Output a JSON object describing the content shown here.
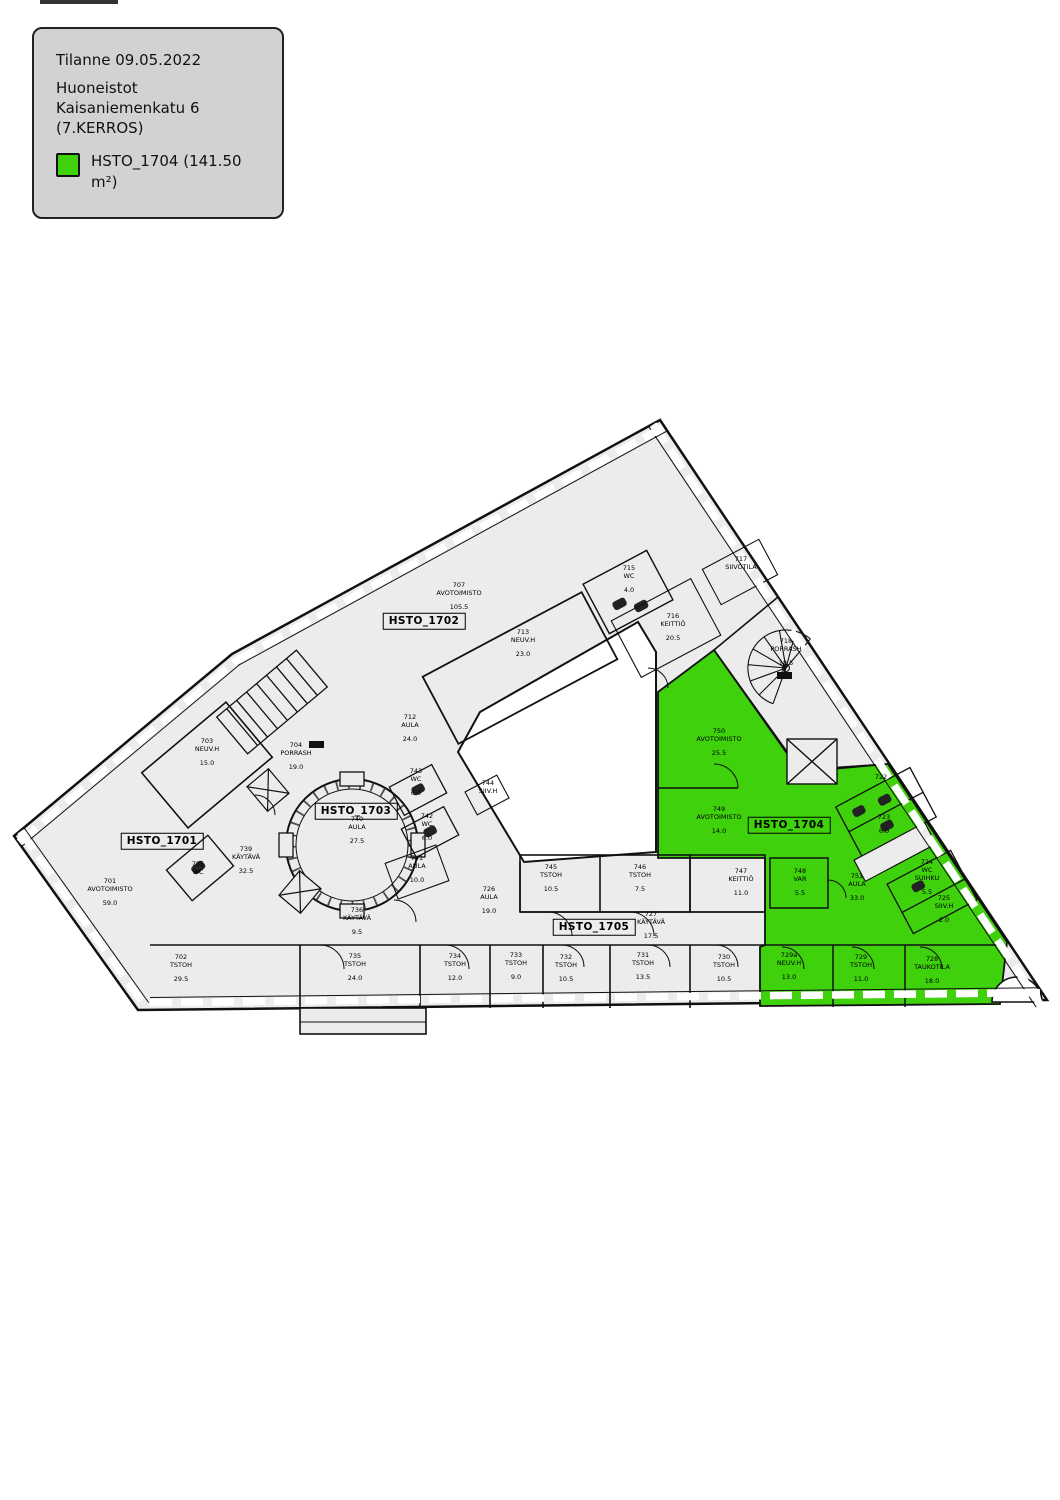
{
  "colors": {
    "highlight_green": "#3ED10C",
    "floor_gray": "#ECECEC",
    "legend_bg": "#D2D2D2",
    "wall": "#111111"
  },
  "legend": {
    "title": "Tilanne 09.05.2022",
    "building_lines": [
      "Huoneistot",
      "Kaisaniemenkatu 6",
      "(7.KERROS)"
    ],
    "item": {
      "label": "HSTO_1704 (141.50 m²)",
      "color": "#3ED10C"
    }
  },
  "units": [
    {
      "label": "HSTO_1701",
      "x": 162,
      "y": 841
    },
    {
      "label": "HSTO_1702",
      "x": 424,
      "y": 621
    },
    {
      "label": "HSTO_1703",
      "x": 356,
      "y": 811
    },
    {
      "label": "HSTO_1704",
      "x": 789,
      "y": 825
    },
    {
      "label": "HSTO_1705",
      "x": 594,
      "y": 927
    }
  ],
  "rooms": [
    {
      "number": "701",
      "name": "AVOTOIMISTO",
      "area": "59.0",
      "x": 110,
      "y": 892,
      "highlight": false
    },
    {
      "number": "702",
      "name": "TSTOH",
      "area": "29.5",
      "x": 181,
      "y": 968,
      "highlight": false
    },
    {
      "number": "703",
      "name": "NEUV.H",
      "area": "15.0",
      "x": 207,
      "y": 752,
      "highlight": false
    },
    {
      "number": "704",
      "name": "PORRASH",
      "area": "19.0",
      "x": 296,
      "y": 756,
      "highlight": false
    },
    {
      "number": "705",
      "name": "WC",
      "area": "",
      "x": 198,
      "y": 868,
      "highlight": false
    },
    {
      "number": "707",
      "name": "AVOTOIMISTO",
      "area": "105.5",
      "x": 459,
      "y": 596,
      "highlight": false
    },
    {
      "number": "712",
      "name": "AULA",
      "area": "24.0",
      "x": 410,
      "y": 728,
      "highlight": false
    },
    {
      "number": "713",
      "name": "NEUV.H",
      "area": "23.0",
      "x": 523,
      "y": 643,
      "highlight": false
    },
    {
      "number": "715",
      "name": "WC",
      "area": "4.0",
      "x": 629,
      "y": 579,
      "highlight": false
    },
    {
      "number": "716",
      "name": "KEITTIÖ",
      "area": "20.5",
      "x": 673,
      "y": 627,
      "highlight": false
    },
    {
      "number": "717",
      "name": "SIIVOTILA",
      "area": "",
      "x": 741,
      "y": 563,
      "highlight": false
    },
    {
      "number": "718",
      "name": "PORRASH",
      "area": "18.5",
      "x": 786,
      "y": 652,
      "highlight": false
    },
    {
      "number": "722",
      "name": "",
      "area": "",
      "x": 881,
      "y": 777,
      "highlight": true
    },
    {
      "number": "723",
      "name": "",
      "area": "6.0",
      "x": 884,
      "y": 824,
      "highlight": true
    },
    {
      "number": "724",
      "name": "WC\nSUIHKU",
      "area": "5.5",
      "x": 927,
      "y": 877,
      "highlight": true
    },
    {
      "number": "725",
      "name": "SIIV.H",
      "area": "2.0",
      "x": 944,
      "y": 909,
      "highlight": true
    },
    {
      "number": "726",
      "name": "AULA",
      "area": "19.0",
      "x": 489,
      "y": 900,
      "highlight": false
    },
    {
      "number": "727",
      "name": "KÄYTÄVÄ",
      "area": "17.5",
      "x": 651,
      "y": 925,
      "highlight": false
    },
    {
      "number": "728",
      "name": "TAUKOTILA",
      "area": "18.0",
      "x": 932,
      "y": 970,
      "highlight": true
    },
    {
      "number": "729",
      "name": "TSTOH",
      "area": "11.0",
      "x": 861,
      "y": 968,
      "highlight": true
    },
    {
      "number": "729a",
      "name": "NEUV.H",
      "area": "13.0",
      "x": 789,
      "y": 966,
      "highlight": true
    },
    {
      "number": "730",
      "name": "TSTOH",
      "area": "10.5",
      "x": 724,
      "y": 968,
      "highlight": false
    },
    {
      "number": "731",
      "name": "TSTOH",
      "area": "13.5",
      "x": 643,
      "y": 966,
      "highlight": false
    },
    {
      "number": "732",
      "name": "TSTOH",
      "area": "10.5",
      "x": 566,
      "y": 968,
      "highlight": false
    },
    {
      "number": "733",
      "name": "TSTOH",
      "area": "9.0",
      "x": 516,
      "y": 966,
      "highlight": false
    },
    {
      "number": "734",
      "name": "TSTOH",
      "area": "12.0",
      "x": 455,
      "y": 967,
      "highlight": false
    },
    {
      "number": "735",
      "name": "TSTOH",
      "area": "24.0",
      "x": 355,
      "y": 967,
      "highlight": false
    },
    {
      "number": "736",
      "name": "KÄYTÄVÄ",
      "area": "9.5",
      "x": 357,
      "y": 921,
      "highlight": false
    },
    {
      "number": "739",
      "name": "KÄYTÄVÄ",
      "area": "32.5",
      "x": 246,
      "y": 860,
      "highlight": false
    },
    {
      "number": "740",
      "name": "AULA",
      "area": "27.5",
      "x": 357,
      "y": 830,
      "highlight": false
    },
    {
      "number": "741",
      "name": "AULA",
      "area": "10.0",
      "x": 417,
      "y": 869,
      "highlight": false
    },
    {
      "number": "742",
      "name": "WC",
      "area": "6.0",
      "x": 427,
      "y": 827,
      "highlight": false
    },
    {
      "number": "743",
      "name": "WC",
      "area": "6.0",
      "x": 416,
      "y": 782,
      "highlight": false
    },
    {
      "number": "744",
      "name": "SIIV.H",
      "area": "",
      "x": 488,
      "y": 787,
      "highlight": false
    },
    {
      "number": "745",
      "name": "TSTOH",
      "area": "10.5",
      "x": 551,
      "y": 878,
      "highlight": false
    },
    {
      "number": "746",
      "name": "TSTOH",
      "area": "7.5",
      "x": 640,
      "y": 878,
      "highlight": false
    },
    {
      "number": "747",
      "name": "KEITTIÖ",
      "area": "11.0",
      "x": 741,
      "y": 882,
      "highlight": false
    },
    {
      "number": "748",
      "name": "VAR",
      "area": "5.5",
      "x": 800,
      "y": 882,
      "highlight": true
    },
    {
      "number": "749",
      "name": "AVOTOIMISTO",
      "area": "14.0",
      "x": 719,
      "y": 820,
      "highlight": true
    },
    {
      "number": "750",
      "name": "AVOTOIMISTO",
      "area": "25.5",
      "x": 719,
      "y": 742,
      "highlight": true
    },
    {
      "number": "751",
      "name": "AULA",
      "area": "33.0",
      "x": 857,
      "y": 887,
      "highlight": true
    }
  ]
}
